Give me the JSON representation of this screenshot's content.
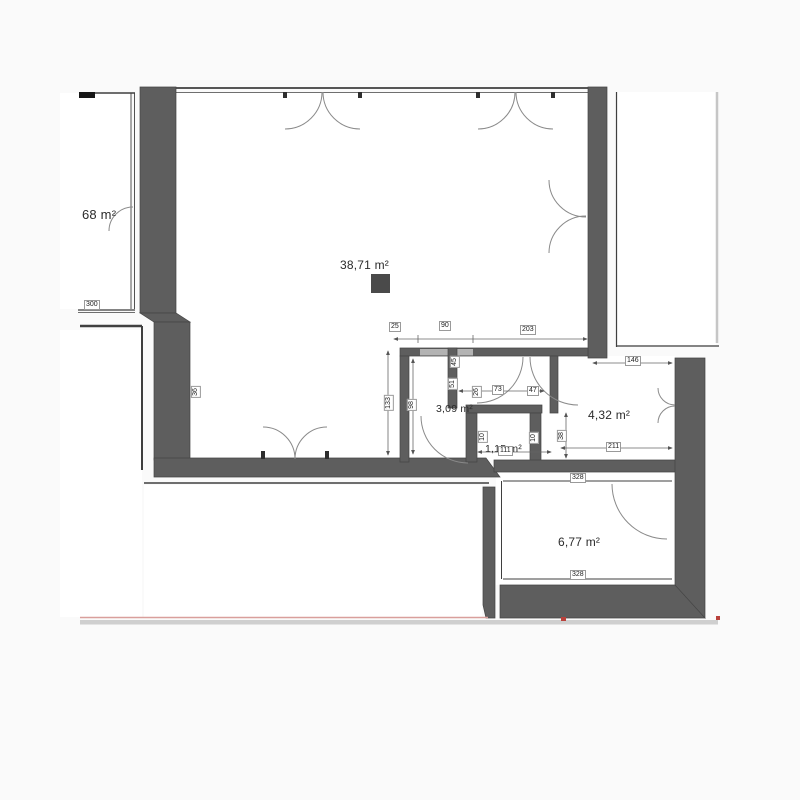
{
  "plan": {
    "title": "apartment-floor-plan",
    "rooms": [
      {
        "id": "room-left-unit",
        "label": "68 m²"
      },
      {
        "id": "room-living",
        "label": "38,71 m²"
      },
      {
        "id": "room-bath",
        "label": "3,09 m²"
      },
      {
        "id": "room-wc",
        "label": "1,15 m²"
      },
      {
        "id": "room-hall",
        "label": "4,32 m²"
      },
      {
        "id": "room-storage",
        "label": "6,77 m²"
      }
    ],
    "dims": {
      "w25": "25",
      "w90": "90",
      "w203": "203",
      "w146": "146",
      "w300": "300",
      "h133": "133",
      "h98": "98",
      "h51": "51",
      "h45": "45",
      "h36": "36",
      "w73": "73",
      "w47": "47",
      "w26": "26",
      "w111": "111",
      "w211": "211",
      "w328_top": "328",
      "w328_bottom": "328",
      "h38": "38",
      "h10_left": "10",
      "h10_right": "10"
    },
    "colors": {
      "wall": "#5e5e5e",
      "lintel": "#b3b3b3",
      "slab": "#cfcfcf",
      "accent_line": "#d99f9c",
      "marker": "#b9413b"
    }
  }
}
